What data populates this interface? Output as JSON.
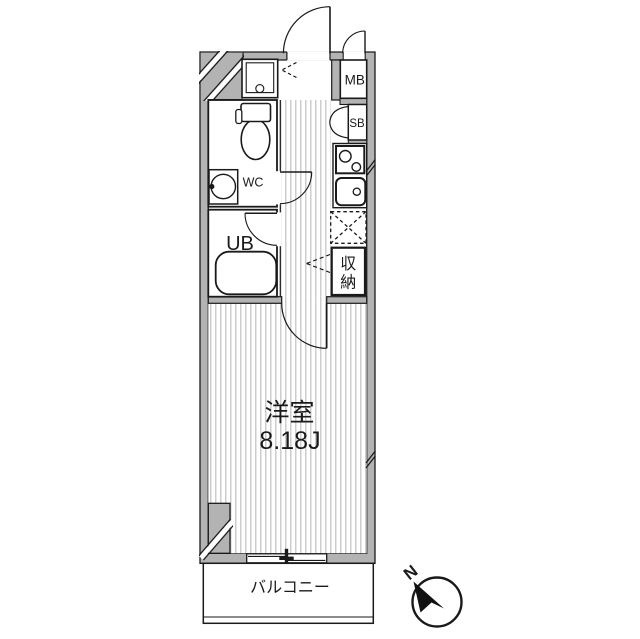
{
  "floorplan": {
    "main_room": {
      "name": "洋室",
      "size": "8.18J"
    },
    "balcony": {
      "label": "バルコニー"
    },
    "rooms": {
      "wc": "WC",
      "unit_bath": "UB",
      "meter_box": "MB",
      "shoe_box": "SB",
      "storage": "収納"
    },
    "compass": {
      "north_label": "N"
    },
    "colors": {
      "wall": "#b3b3b3",
      "line": "#1a1a1a",
      "floor_stripe": "#cdcdcd",
      "background": "#ffffff"
    }
  }
}
